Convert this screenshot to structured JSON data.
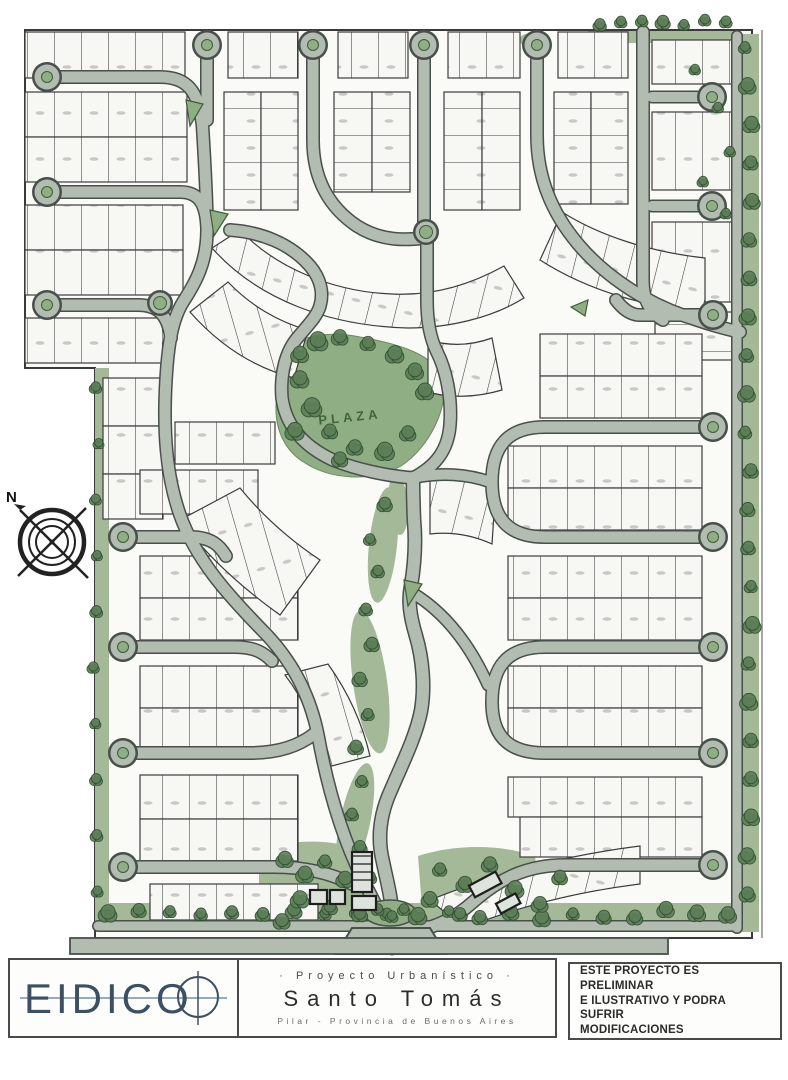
{
  "map": {
    "plaza_label": "PLAZA",
    "north_label": "N"
  },
  "footer": {
    "brand": "EIDICO",
    "project_kicker": "· Proyecto Urbanístico ·",
    "project_name": "Santo Tomás",
    "project_location": "Pilar - Provincia de Buenos Aires",
    "disclaimer_line1": "ESTE PROYECTO ES PRELIMINAR",
    "disclaimer_line2": "E ILUSTRATIVO Y PODRA SUFRIR",
    "disclaimer_line3": "MODIFICACIONES"
  },
  "colors": {
    "road": "#b3bcb0",
    "road_casing": "#47504a",
    "green": "#a3b998",
    "green_dark": "#8fae84",
    "tree": "#5d7f58",
    "tree_stroke": "#2e4d2e",
    "lot": "#f7f7f4",
    "lot_line": "#3c3c3c",
    "brand_navy": "#3c4f63"
  }
}
